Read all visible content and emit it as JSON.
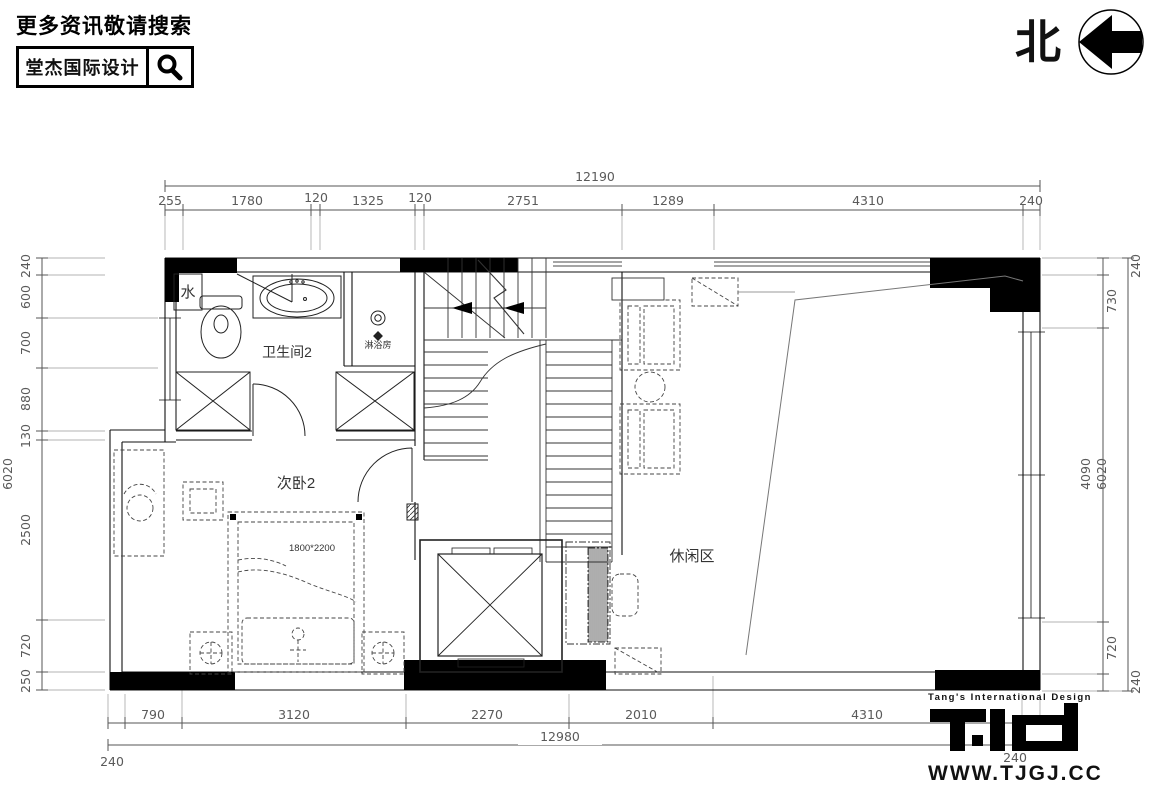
{
  "header": {
    "search_hint": "更多资讯敬请搜索",
    "brand": "堂杰国际设计",
    "search_icon": "magnifier-icon",
    "north_label": "北",
    "north_icon": "north-arrow-icon"
  },
  "plan": {
    "rooms": {
      "water": "水",
      "bathroom": "卫生间2",
      "shower": "淋浴房",
      "bedroom": "次卧2",
      "leisure": "休闲区",
      "bed_size": "1800*2200"
    }
  },
  "dimensions": {
    "top": {
      "total": "12190",
      "segments": [
        "255",
        "1780",
        "120",
        "1325",
        "120",
        "2751",
        "1289",
        "4310",
        "240"
      ]
    },
    "bottom": {
      "total": "12980",
      "outer_left": "240",
      "outer_right": "240",
      "segments": [
        "790",
        "3120",
        "2270",
        "2010",
        "4310"
      ]
    },
    "left": {
      "total": "6020",
      "segments": [
        "240",
        "600",
        "700",
        "880",
        "130",
        "2500",
        "720",
        "250"
      ]
    },
    "right": {
      "total": "6020",
      "outer_top": "240",
      "outer_bottom": "240",
      "segments": [
        "730",
        "4090",
        "720"
      ]
    }
  },
  "footer": {
    "tagline": "Tang's International Design",
    "logo": "TID",
    "website": "WWW.TJGJ.CC"
  },
  "colors": {
    "ink": "#000000",
    "dim_text": "#5a5a5a",
    "background": "#ffffff"
  }
}
